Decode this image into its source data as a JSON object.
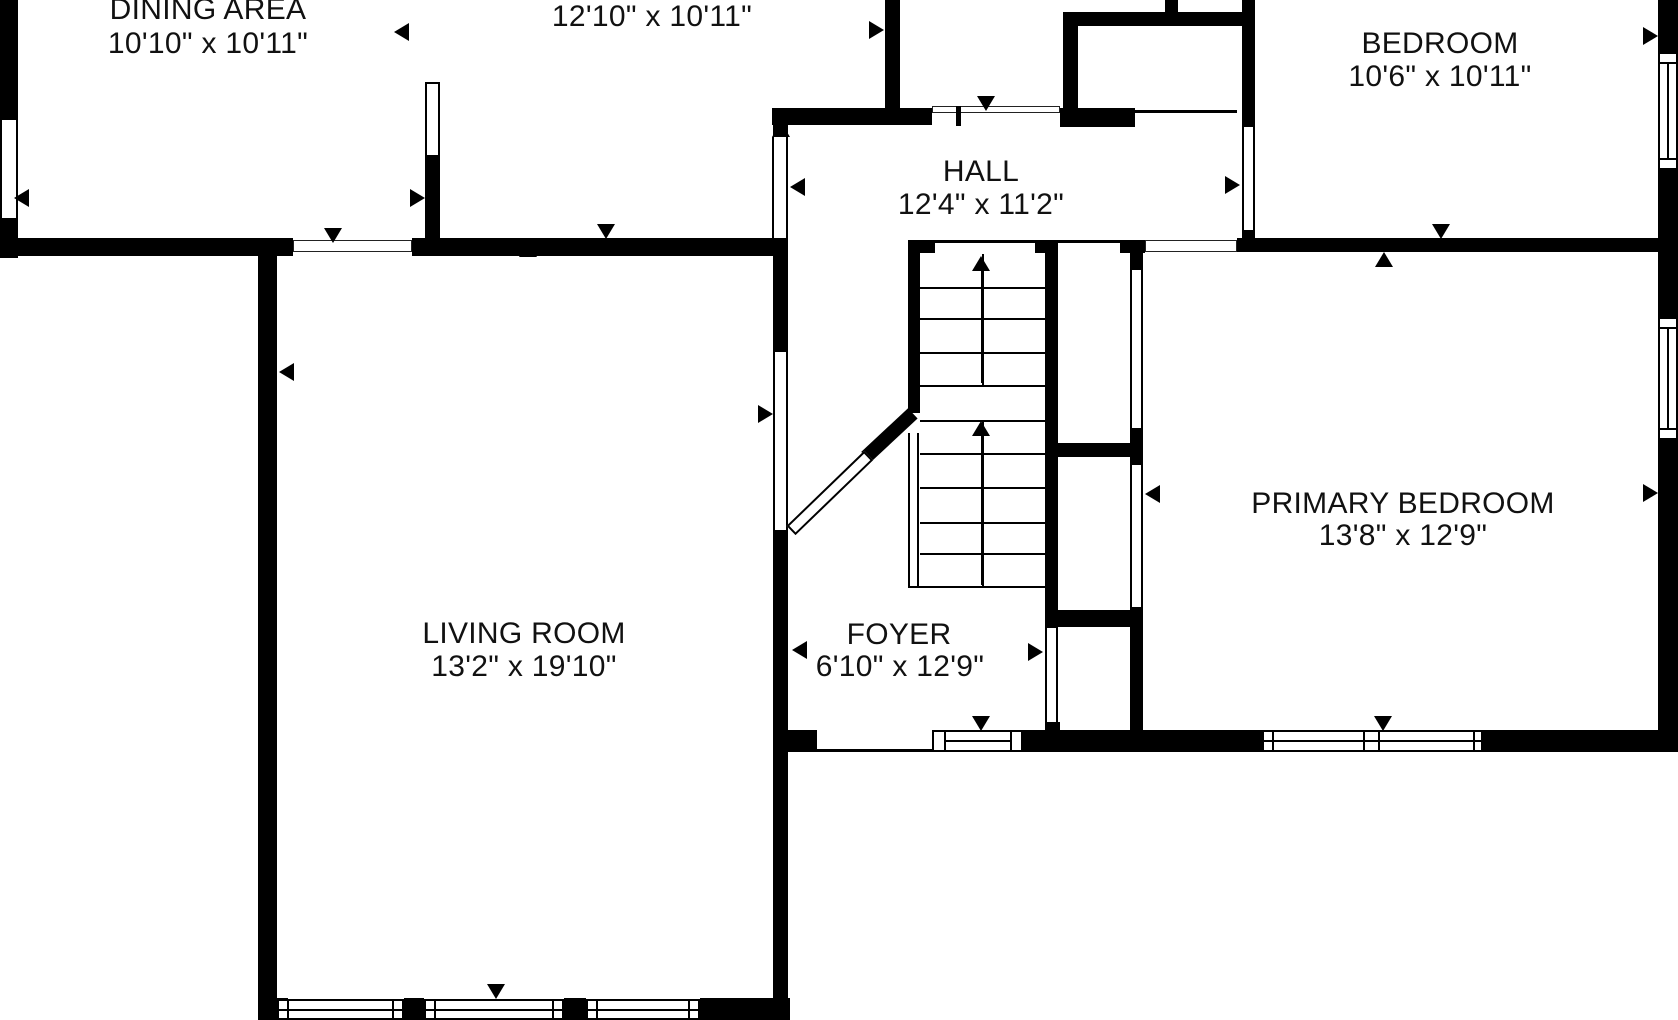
{
  "title": "First floor plan",
  "rooms": {
    "dining": {
      "name": "DINING AREA",
      "dims": "10'10\" x 10'11\""
    },
    "kitchen": {
      "name": "",
      "dims": "12'10\" x 10'11\""
    },
    "hall": {
      "name": "HALL",
      "dims": "12'4\" x 11'2\""
    },
    "bedroom": {
      "name": "BEDROOM",
      "dims": "10'6\" x 10'11\""
    },
    "living": {
      "name": "LIVING ROOM",
      "dims": "13'2\" x 19'10\""
    },
    "foyer": {
      "name": "FOYER",
      "dims": "6'10\" x 12'9\""
    },
    "primary": {
      "name": "PRIMARY BEDROOM",
      "dims": "13'8\" x 12'9\""
    }
  },
  "icons": {
    "direction-arrow": "filled triangle marking door/window opening direction",
    "stair-arrow": "arrow with stem showing stairs going up"
  },
  "colors": {
    "wall": "#000000",
    "background": "#ffffff",
    "text": "#111111"
  }
}
